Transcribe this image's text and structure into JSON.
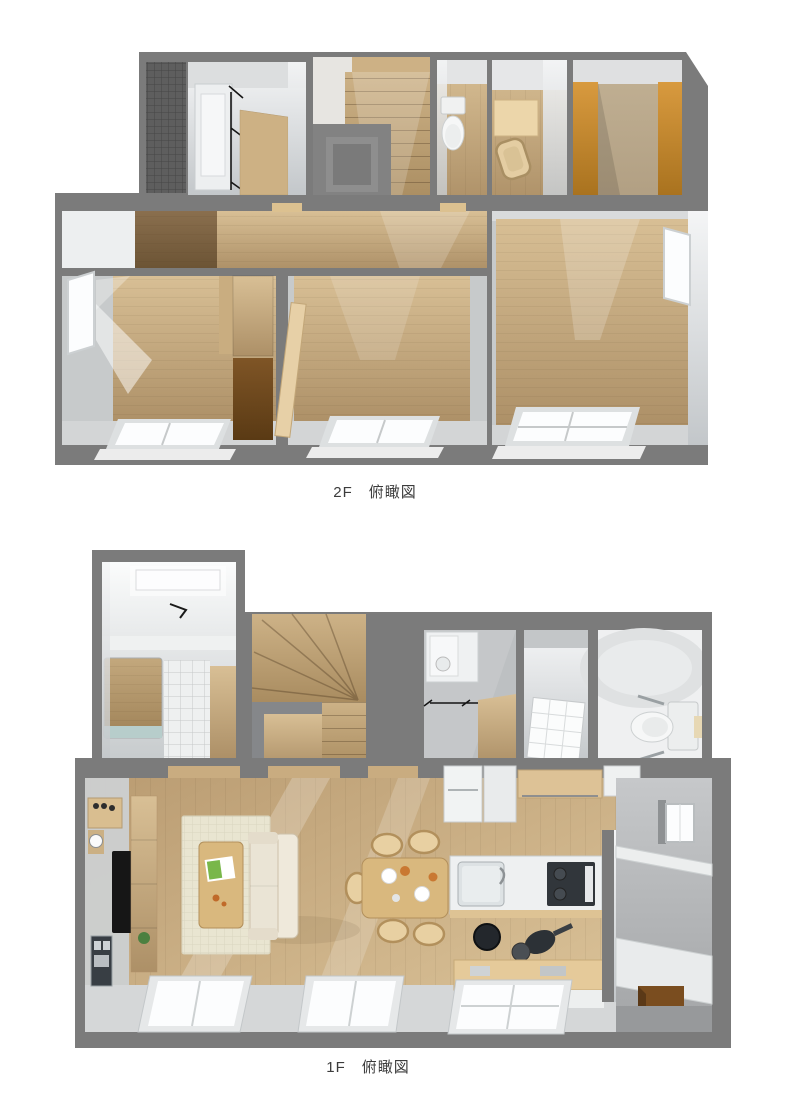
{
  "figures": {
    "f2": {
      "caption": "2F　俯瞰図"
    },
    "f1": {
      "caption": "1F　俯瞰図"
    }
  },
  "palette": {
    "background": "#ffffff",
    "caption-color": "#3c3c3c",
    "wall-cut": "#7b7b7b",
    "balcony-deck": "#5e5e5e",
    "wood-floor": "#c6aa80",
    "wood-dark": "#8a6f4e",
    "closet-brown": "#6e4722",
    "closet-orange": "#c68c35",
    "door-wood": "#cdb184",
    "stair-wood": "#bfa176",
    "window-glass": "#fcfdfe",
    "window-frame": "#c6c9ca",
    "fixture-white": "#f2f3f3",
    "tile-gray": "#bdc0c2",
    "sofa": "#eae4d5",
    "rug": "#e9e5d1",
    "table-wood": "#d9b87e",
    "tv-black": "#161616",
    "stove-black": "#31363b",
    "genkan-mat": "#7a4d1f"
  }
}
